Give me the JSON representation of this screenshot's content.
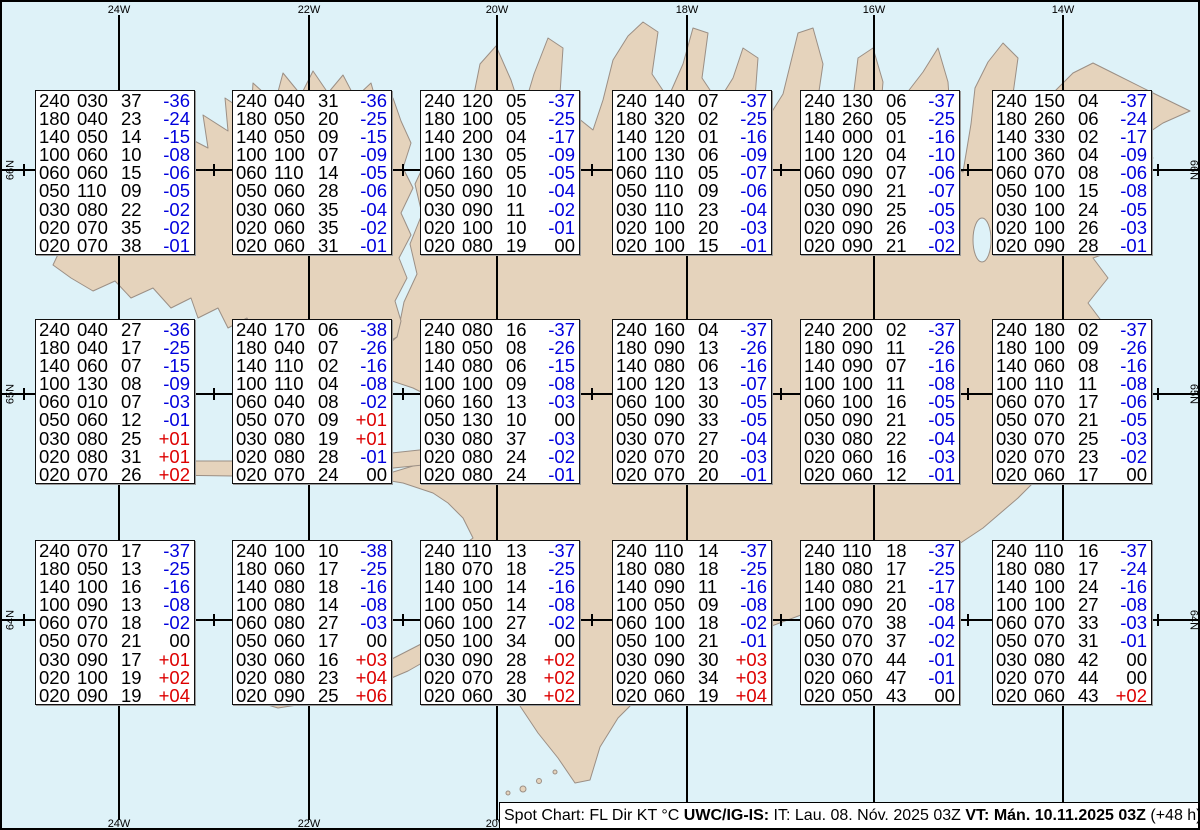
{
  "colors": {
    "ocean": "#def2f8",
    "land": "#e5d3bc",
    "coastline": "#9b8f85",
    "temp_negative": "#0000dd",
    "temp_positive": "#dd0000",
    "temp_zero": "#000000",
    "grid_line": "#000000",
    "box_background": "#ffffff"
  },
  "graticule": {
    "meridians": [
      {
        "label": "24W",
        "x": 117
      },
      {
        "label": "22W",
        "x": 307
      },
      {
        "label": "20W",
        "x": 495
      },
      {
        "label": "18W",
        "x": 685
      },
      {
        "label": "16W",
        "x": 872
      },
      {
        "label": "14W",
        "x": 1061
      }
    ],
    "parallels": [
      {
        "label": "66N",
        "y": 168
      },
      {
        "label": "65N",
        "y": 392
      },
      {
        "label": "64N",
        "y": 618
      }
    ],
    "minor_tick_x": [
      22,
      212,
      401,
      590,
      779,
      966,
      1156
    ]
  },
  "status_bar": {
    "segments": [
      {
        "text": "Spot Chart: FL Dir KT °C ",
        "bold": false
      },
      {
        "text": "UWC/IG-IS:",
        "bold": true
      },
      {
        "text": " IT: Lau. 08. Nóv. 2025 03Z ",
        "bold": false
      },
      {
        "text": "VT: Mán. 10.11.2025 03Z",
        "bold": true
      },
      {
        "text": " (+48 h)",
        "bold": false
      }
    ]
  },
  "chart_data": {
    "type": "table",
    "title": "Spot Chart: FL Dir KT °C",
    "issued": "IT: Lau. 08. Nóv. 2025 03Z",
    "valid_time": "VT: Mán. 10.11.2025 03Z (+48 h)",
    "columns": [
      "FL",
      "Dir",
      "KT",
      "TempC"
    ],
    "grid": {
      "rows": 3,
      "cols": 6
    },
    "box_layout": {
      "col_x": [
        33,
        230,
        418,
        610,
        798,
        990
      ],
      "row_y": [
        88,
        317,
        538
      ],
      "width": 160,
      "height": 165
    },
    "stations": [
      {
        "grid_row": 1,
        "grid_col": 1,
        "levels": [
          [
            "240",
            "030",
            "37",
            "-36"
          ],
          [
            "180",
            "040",
            "23",
            "-24"
          ],
          [
            "140",
            "050",
            "14",
            "-15"
          ],
          [
            "100",
            "060",
            "10",
            "-08"
          ],
          [
            "060",
            "060",
            "15",
            "-06"
          ],
          [
            "050",
            "110",
            "09",
            "-05"
          ],
          [
            "030",
            "080",
            "22",
            "-02"
          ],
          [
            "020",
            "070",
            "35",
            "-02"
          ],
          [
            "020",
            "070",
            "38",
            "-01"
          ]
        ]
      },
      {
        "grid_row": 1,
        "grid_col": 2,
        "levels": [
          [
            "240",
            "040",
            "31",
            "-36"
          ],
          [
            "180",
            "050",
            "20",
            "-25"
          ],
          [
            "140",
            "050",
            "09",
            "-15"
          ],
          [
            "100",
            "100",
            "07",
            "-09"
          ],
          [
            "060",
            "110",
            "14",
            "-05"
          ],
          [
            "050",
            "060",
            "28",
            "-06"
          ],
          [
            "030",
            "060",
            "35",
            "-04"
          ],
          [
            "020",
            "060",
            "35",
            "-02"
          ],
          [
            "020",
            "060",
            "31",
            "-01"
          ]
        ]
      },
      {
        "grid_row": 1,
        "grid_col": 3,
        "levels": [
          [
            "240",
            "120",
            "05",
            "-37"
          ],
          [
            "180",
            "100",
            "05",
            "-25"
          ],
          [
            "140",
            "200",
            "04",
            "-17"
          ],
          [
            "100",
            "130",
            "05",
            "-09"
          ],
          [
            "060",
            "160",
            "05",
            "-05"
          ],
          [
            "050",
            "090",
            "10",
            "-04"
          ],
          [
            "030",
            "090",
            "11",
            "-02"
          ],
          [
            "020",
            "100",
            "10",
            "-01"
          ],
          [
            "020",
            "080",
            "19",
            "00"
          ]
        ]
      },
      {
        "grid_row": 1,
        "grid_col": 4,
        "levels": [
          [
            "240",
            "140",
            "07",
            "-37"
          ],
          [
            "180",
            "320",
            "02",
            "-25"
          ],
          [
            "140",
            "120",
            "01",
            "-16"
          ],
          [
            "100",
            "130",
            "06",
            "-09"
          ],
          [
            "060",
            "110",
            "05",
            "-07"
          ],
          [
            "050",
            "110",
            "09",
            "-06"
          ],
          [
            "030",
            "110",
            "23",
            "-04"
          ],
          [
            "020",
            "100",
            "20",
            "-03"
          ],
          [
            "020",
            "100",
            "15",
            "-01"
          ]
        ]
      },
      {
        "grid_row": 1,
        "grid_col": 5,
        "levels": [
          [
            "240",
            "130",
            "06",
            "-37"
          ],
          [
            "180",
            "260",
            "05",
            "-25"
          ],
          [
            "140",
            "000",
            "01",
            "-16"
          ],
          [
            "100",
            "120",
            "04",
            "-10"
          ],
          [
            "060",
            "090",
            "07",
            "-06"
          ],
          [
            "050",
            "090",
            "21",
            "-07"
          ],
          [
            "030",
            "090",
            "25",
            "-05"
          ],
          [
            "020",
            "090",
            "26",
            "-03"
          ],
          [
            "020",
            "090",
            "21",
            "-02"
          ]
        ]
      },
      {
        "grid_row": 1,
        "grid_col": 6,
        "levels": [
          [
            "240",
            "150",
            "04",
            "-37"
          ],
          [
            "180",
            "260",
            "06",
            "-24"
          ],
          [
            "140",
            "330",
            "02",
            "-17"
          ],
          [
            "100",
            "360",
            "04",
            "-09"
          ],
          [
            "060",
            "070",
            "08",
            "-06"
          ],
          [
            "050",
            "100",
            "15",
            "-08"
          ],
          [
            "030",
            "100",
            "24",
            "-05"
          ],
          [
            "020",
            "100",
            "26",
            "-03"
          ],
          [
            "020",
            "090",
            "28",
            "-01"
          ]
        ]
      },
      {
        "grid_row": 2,
        "grid_col": 1,
        "levels": [
          [
            "240",
            "040",
            "27",
            "-36"
          ],
          [
            "180",
            "040",
            "17",
            "-25"
          ],
          [
            "140",
            "060",
            "07",
            "-15"
          ],
          [
            "100",
            "130",
            "08",
            "-09"
          ],
          [
            "060",
            "010",
            "07",
            "-03"
          ],
          [
            "050",
            "060",
            "12",
            "-01"
          ],
          [
            "030",
            "080",
            "25",
            "+01"
          ],
          [
            "020",
            "080",
            "31",
            "+01"
          ],
          [
            "020",
            "070",
            "26",
            "+02"
          ]
        ]
      },
      {
        "grid_row": 2,
        "grid_col": 2,
        "levels": [
          [
            "240",
            "170",
            "06",
            "-38"
          ],
          [
            "180",
            "040",
            "07",
            "-26"
          ],
          [
            "140",
            "110",
            "02",
            "-16"
          ],
          [
            "100",
            "110",
            "04",
            "-08"
          ],
          [
            "060",
            "040",
            "08",
            "-02"
          ],
          [
            "050",
            "070",
            "09",
            "+01"
          ],
          [
            "030",
            "080",
            "19",
            "+01"
          ],
          [
            "020",
            "080",
            "28",
            "-01"
          ],
          [
            "020",
            "070",
            "24",
            "00"
          ]
        ]
      },
      {
        "grid_row": 2,
        "grid_col": 3,
        "levels": [
          [
            "240",
            "080",
            "16",
            "-37"
          ],
          [
            "180",
            "050",
            "08",
            "-26"
          ],
          [
            "140",
            "080",
            "06",
            "-15"
          ],
          [
            "100",
            "100",
            "09",
            "-08"
          ],
          [
            "060",
            "160",
            "13",
            "-03"
          ],
          [
            "050",
            "130",
            "10",
            "00"
          ],
          [
            "030",
            "080",
            "37",
            "-03"
          ],
          [
            "020",
            "080",
            "24",
            "-02"
          ],
          [
            "020",
            "080",
            "24",
            "-01"
          ]
        ]
      },
      {
        "grid_row": 2,
        "grid_col": 4,
        "levels": [
          [
            "240",
            "160",
            "04",
            "-37"
          ],
          [
            "180",
            "090",
            "13",
            "-26"
          ],
          [
            "140",
            "080",
            "06",
            "-16"
          ],
          [
            "100",
            "120",
            "13",
            "-07"
          ],
          [
            "060",
            "100",
            "30",
            "-05"
          ],
          [
            "050",
            "090",
            "33",
            "-05"
          ],
          [
            "030",
            "070",
            "27",
            "-04"
          ],
          [
            "020",
            "070",
            "20",
            "-03"
          ],
          [
            "020",
            "070",
            "20",
            "-01"
          ]
        ]
      },
      {
        "grid_row": 2,
        "grid_col": 5,
        "levels": [
          [
            "240",
            "200",
            "02",
            "-37"
          ],
          [
            "180",
            "090",
            "11",
            "-26"
          ],
          [
            "140",
            "090",
            "07",
            "-16"
          ],
          [
            "100",
            "100",
            "11",
            "-08"
          ],
          [
            "060",
            "100",
            "16",
            "-05"
          ],
          [
            "050",
            "090",
            "21",
            "-05"
          ],
          [
            "030",
            "080",
            "22",
            "-04"
          ],
          [
            "020",
            "060",
            "16",
            "-03"
          ],
          [
            "020",
            "060",
            "12",
            "-01"
          ]
        ]
      },
      {
        "grid_row": 2,
        "grid_col": 6,
        "levels": [
          [
            "240",
            "180",
            "02",
            "-37"
          ],
          [
            "180",
            "100",
            "09",
            "-26"
          ],
          [
            "140",
            "060",
            "08",
            "-16"
          ],
          [
            "100",
            "110",
            "11",
            "-08"
          ],
          [
            "060",
            "070",
            "17",
            "-06"
          ],
          [
            "050",
            "070",
            "21",
            "-05"
          ],
          [
            "030",
            "070",
            "25",
            "-03"
          ],
          [
            "020",
            "070",
            "23",
            "-02"
          ],
          [
            "020",
            "060",
            "17",
            "00"
          ]
        ]
      },
      {
        "grid_row": 3,
        "grid_col": 1,
        "levels": [
          [
            "240",
            "070",
            "17",
            "-37"
          ],
          [
            "180",
            "050",
            "13",
            "-25"
          ],
          [
            "140",
            "100",
            "16",
            "-16"
          ],
          [
            "100",
            "090",
            "13",
            "-08"
          ],
          [
            "060",
            "070",
            "18",
            "-02"
          ],
          [
            "050",
            "070",
            "21",
            "00"
          ],
          [
            "030",
            "090",
            "17",
            "+01"
          ],
          [
            "020",
            "100",
            "19",
            "+02"
          ],
          [
            "020",
            "090",
            "19",
            "+04"
          ]
        ]
      },
      {
        "grid_row": 3,
        "grid_col": 2,
        "levels": [
          [
            "240",
            "100",
            "10",
            "-38"
          ],
          [
            "180",
            "060",
            "17",
            "-25"
          ],
          [
            "140",
            "080",
            "18",
            "-16"
          ],
          [
            "100",
            "080",
            "14",
            "-08"
          ],
          [
            "060",
            "080",
            "27",
            "-03"
          ],
          [
            "050",
            "060",
            "17",
            "00"
          ],
          [
            "030",
            "060",
            "16",
            "+03"
          ],
          [
            "020",
            "080",
            "23",
            "+04"
          ],
          [
            "020",
            "090",
            "25",
            "+06"
          ]
        ]
      },
      {
        "grid_row": 3,
        "grid_col": 3,
        "levels": [
          [
            "240",
            "110",
            "13",
            "-37"
          ],
          [
            "180",
            "070",
            "18",
            "-25"
          ],
          [
            "140",
            "100",
            "14",
            "-16"
          ],
          [
            "100",
            "050",
            "14",
            "-08"
          ],
          [
            "060",
            "100",
            "27",
            "-02"
          ],
          [
            "050",
            "100",
            "34",
            "00"
          ],
          [
            "030",
            "090",
            "28",
            "+02"
          ],
          [
            "020",
            "070",
            "28",
            "+02"
          ],
          [
            "020",
            "060",
            "30",
            "+02"
          ]
        ]
      },
      {
        "grid_row": 3,
        "grid_col": 4,
        "levels": [
          [
            "240",
            "110",
            "14",
            "-37"
          ],
          [
            "180",
            "080",
            "18",
            "-25"
          ],
          [
            "140",
            "090",
            "11",
            "-16"
          ],
          [
            "100",
            "050",
            "09",
            "-08"
          ],
          [
            "060",
            "100",
            "18",
            "-02"
          ],
          [
            "050",
            "100",
            "21",
            "-01"
          ],
          [
            "030",
            "090",
            "30",
            "+03"
          ],
          [
            "020",
            "060",
            "34",
            "+03"
          ],
          [
            "020",
            "060",
            "19",
            "+04"
          ]
        ]
      },
      {
        "grid_row": 3,
        "grid_col": 5,
        "levels": [
          [
            "240",
            "110",
            "18",
            "-37"
          ],
          [
            "180",
            "080",
            "17",
            "-25"
          ],
          [
            "140",
            "080",
            "21",
            "-17"
          ],
          [
            "100",
            "090",
            "20",
            "-08"
          ],
          [
            "060",
            "070",
            "38",
            "-04"
          ],
          [
            "050",
            "070",
            "37",
            "-02"
          ],
          [
            "030",
            "070",
            "44",
            "-01"
          ],
          [
            "020",
            "060",
            "47",
            "-01"
          ],
          [
            "020",
            "050",
            "43",
            "00"
          ]
        ]
      },
      {
        "grid_row": 3,
        "grid_col": 6,
        "levels": [
          [
            "240",
            "110",
            "16",
            "-37"
          ],
          [
            "180",
            "080",
            "17",
            "-24"
          ],
          [
            "140",
            "100",
            "24",
            "-16"
          ],
          [
            "100",
            "100",
            "27",
            "-08"
          ],
          [
            "060",
            "070",
            "33",
            "-03"
          ],
          [
            "050",
            "070",
            "31",
            "-01"
          ],
          [
            "030",
            "080",
            "42",
            "00"
          ],
          [
            "020",
            "070",
            "44",
            "00"
          ],
          [
            "020",
            "060",
            "43",
            "+02"
          ]
        ]
      }
    ]
  }
}
